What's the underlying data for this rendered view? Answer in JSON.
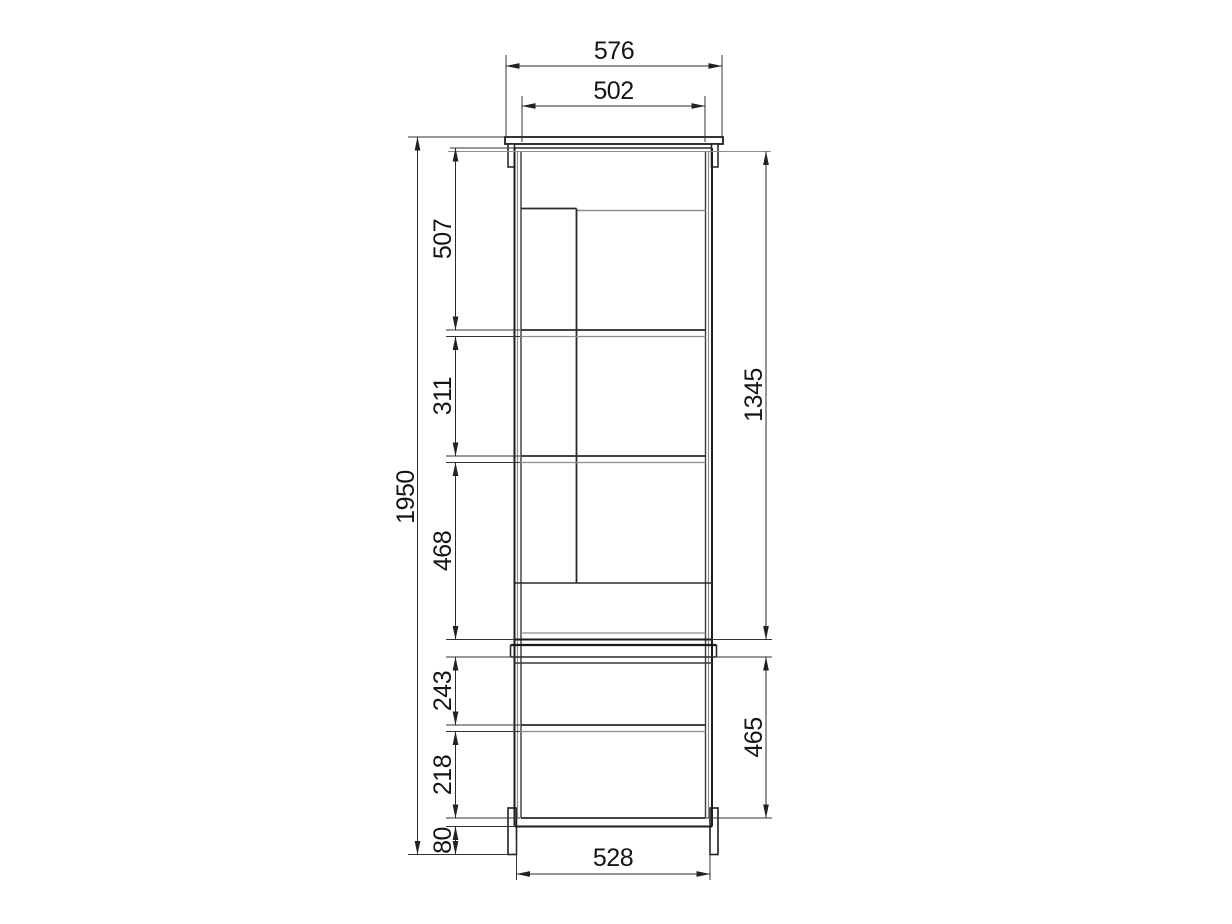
{
  "drawing": {
    "kind": "furniture-front-elevation",
    "accent_color": "#1e1e1e",
    "background_color": "#ffffff",
    "dimensions": {
      "top_board_width": "576",
      "interior_width": "502",
      "overall_height": "1950",
      "upper_opening_1": "507",
      "upper_opening_2": "311",
      "upper_opening_3": "468",
      "upper_section_height": "1345",
      "lower_opening_1": "243",
      "lower_opening_2": "218",
      "plinth_height": "80",
      "lower_section_height": "465",
      "base_width": "528"
    }
  }
}
